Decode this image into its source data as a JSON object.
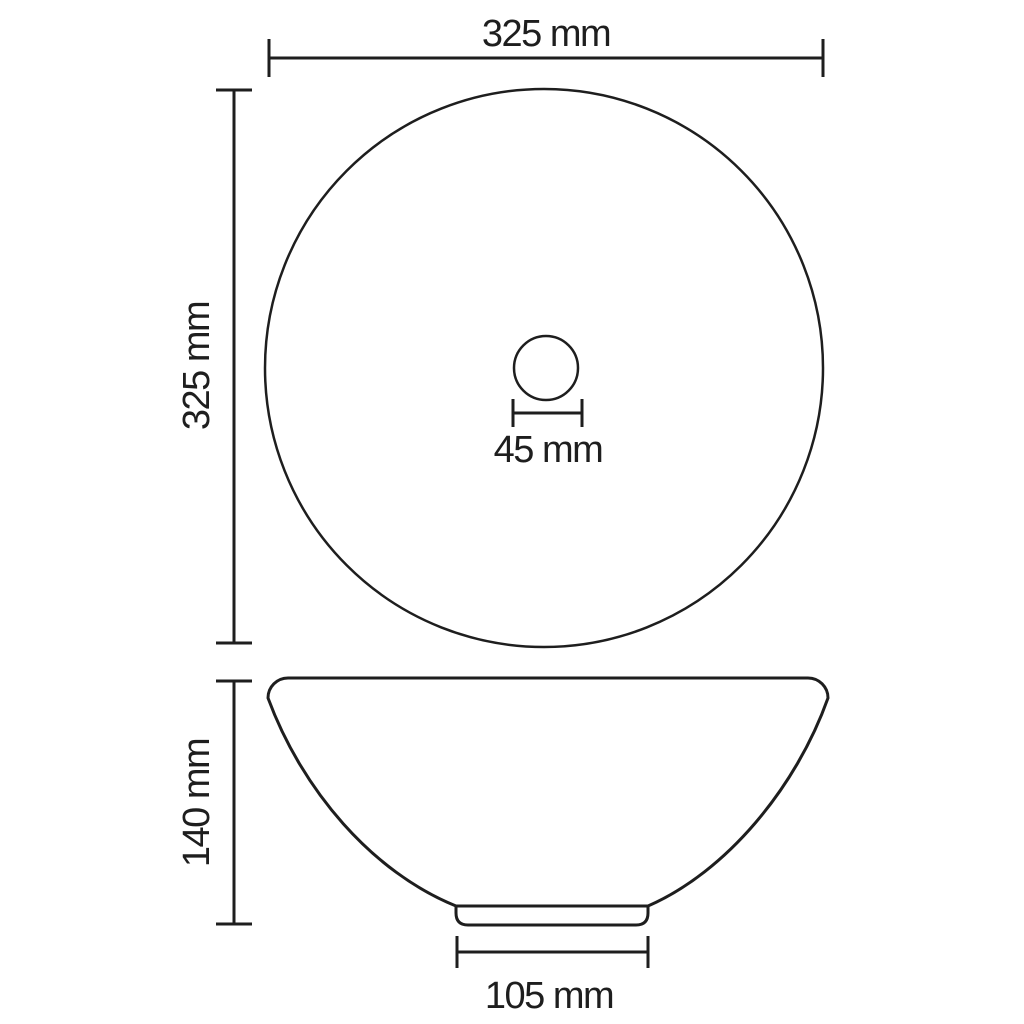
{
  "colors": {
    "line": "#1e1e1e",
    "background": "#ffffff"
  },
  "dimensions": {
    "overall_width": {
      "label": "325 mm",
      "mm": 325
    },
    "overall_depth": {
      "label": "325 mm",
      "mm": 325
    },
    "drain_diameter": {
      "label": "45 mm",
      "mm": 45
    },
    "height": {
      "label": "140 mm",
      "mm": 140
    },
    "base_width": {
      "label": "105 mm",
      "mm": 105
    }
  }
}
